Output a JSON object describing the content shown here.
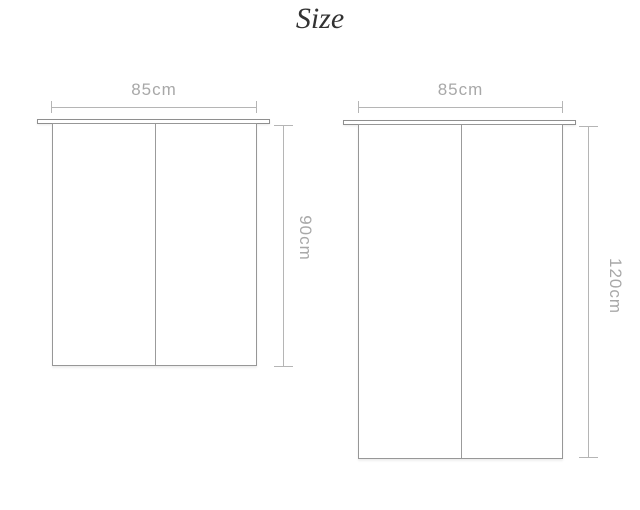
{
  "title": "Size",
  "colors": {
    "background": "#ffffff",
    "title_text": "#333333",
    "dimension_line": "#b5b5b5",
    "dimension_text": "#a8a8a8",
    "panel_outline": "#979797",
    "rod_outline": "#8f8f8f"
  },
  "diagrams": [
    {
      "name": "short-curtain",
      "width_label": "85cm",
      "height_label": "90cm",
      "width_cm": 85,
      "height_cm": 90
    },
    {
      "name": "long-curtain",
      "width_label": "85cm",
      "height_label": "120cm",
      "width_cm": 85,
      "height_cm": 120
    }
  ]
}
